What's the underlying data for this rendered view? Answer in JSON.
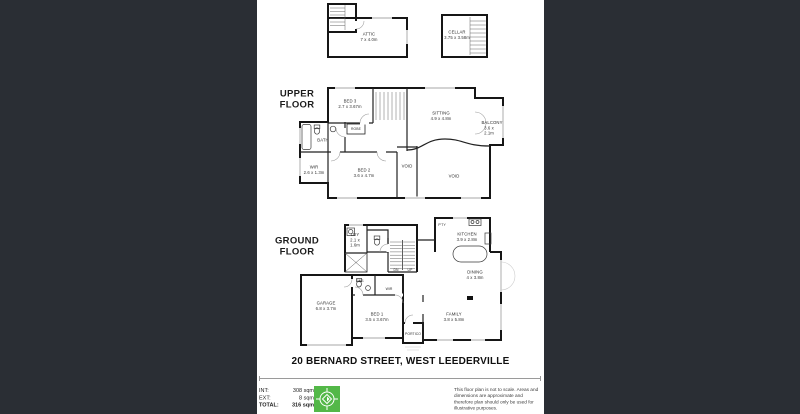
{
  "colors": {
    "backdrop": "#2a2e34",
    "paper": "#ffffff",
    "wall": "#161616",
    "accent_green": "#53b848"
  },
  "floors": {
    "upper": "UPPER FLOOR",
    "ground": "GROUND FLOOR"
  },
  "rooms": {
    "attic": {
      "name": "ATTIC",
      "dims": "7 x 4.0m"
    },
    "cellar": {
      "name": "CELLAR",
      "dims": "3.75 x 3.58m"
    },
    "bed3": {
      "name": "BED 3",
      "dims": "2.7 x 3.67m"
    },
    "sitting": {
      "name": "SITTING",
      "dims": "4.9 x 4.8m"
    },
    "balcony": {
      "name": "BALCONY",
      "dims": "3.6 x 2.1m"
    },
    "bath": {
      "name": "BATH"
    },
    "robe": {
      "name": "ROBE"
    },
    "wir_upper": {
      "name": "WIR",
      "dims": "2.6 x 1.3m"
    },
    "bed2": {
      "name": "BED 2",
      "dims": "3.6 x 4.7m"
    },
    "void_small": {
      "name": "VOID"
    },
    "void_large": {
      "name": "VOID"
    },
    "ldy": {
      "name": "LDY",
      "dims": "2.1 x 1.6m"
    },
    "pty": {
      "name": "P'TY"
    },
    "kitchen": {
      "name": "KITCHEN",
      "dims": "3.9 x 2.8m"
    },
    "stairs_down": {
      "name": "DN"
    },
    "stairs_up": {
      "name": "UP"
    },
    "dining": {
      "name": "DINING",
      "dims": "4 x 3.8m"
    },
    "garage": {
      "name": "GARAGE",
      "dims": "6.8 x 3.7m"
    },
    "ens": {
      "name": "ENS"
    },
    "wir_ground": {
      "name": "WIR"
    },
    "bed1": {
      "name": "BED 1",
      "dims": "3.5 x 3.67m"
    },
    "portico": {
      "name": "PORTICO"
    },
    "family": {
      "name": "FAMILY",
      "dims": "3.8 x 5.8m"
    }
  },
  "footer": {
    "address": "20 BERNARD STREET, WEST LEEDERVILLE",
    "areas": [
      {
        "label": "INT:",
        "value": "308 sqm"
      },
      {
        "label": "EXT:",
        "value": "8 sqm"
      },
      {
        "label": "TOTAL:",
        "value": "316 sqm"
      }
    ],
    "disclaimer": "This floor plan is not to scale. Areas and dimensions are approximate and therefore plan should only be used for illustrative purposes."
  }
}
